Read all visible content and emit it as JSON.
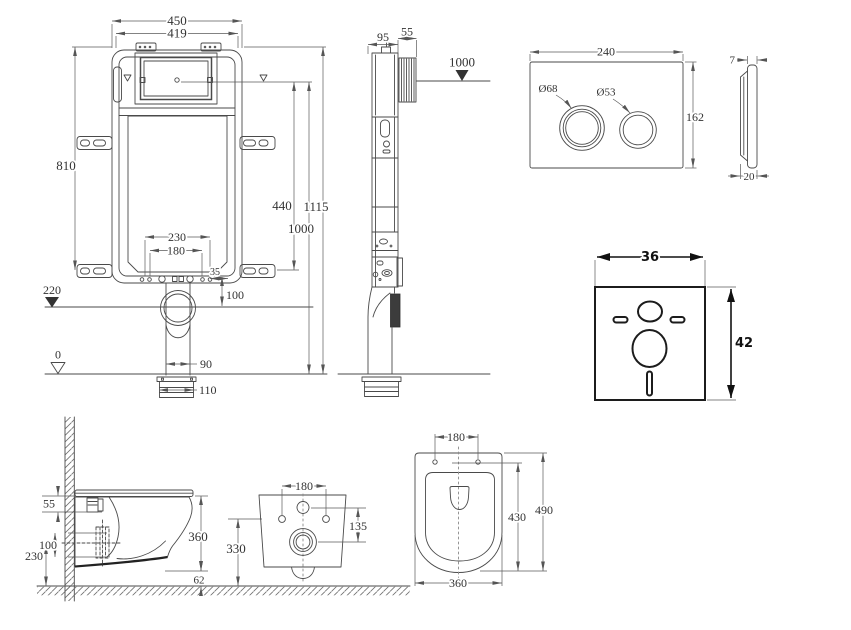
{
  "drawing": {
    "background": "#ffffff",
    "line_color": "#4a4a4a",
    "text_color": "#333333",
    "mat_line_color": "#1c1c1c",
    "views": {
      "cistern_front": {
        "label": "concealed cistern frame front view",
        "dims": {
          "width_outer": "450",
          "width_inner": "419",
          "height": "810",
          "flush_center": "440",
          "total_height": "1115",
          "center_height": "1000",
          "bolt_outer": "230",
          "bolt_inner": "180",
          "edge_offset": "35",
          "outlet_drop": "100",
          "level_upper": "220",
          "level_zero": "0",
          "pipe_width": "90",
          "foot_width": "110"
        }
      },
      "cistern_side": {
        "label": "frame side view",
        "dims": {
          "depth": "95",
          "wall_pipe": "55",
          "level": "1000"
        }
      },
      "flush_plate_front": {
        "label": "flush plate front view",
        "dims": {
          "width": "240",
          "height": "162",
          "big_button": "Ø68",
          "small_button": "Ø53"
        }
      },
      "flush_plate_side": {
        "label": "flush plate side view",
        "dims": {
          "thickness": "7",
          "depth": "20"
        }
      },
      "sound_mat": {
        "label": "sound insulation mat",
        "dims": {
          "width": "36",
          "height": "42"
        }
      },
      "toilet_side": {
        "label": "wall-hung toilet side view",
        "dims": {
          "fixing": "55",
          "outlet_offset": "100",
          "outlet_height": "230",
          "body_height": "360",
          "clearance": "62"
        }
      },
      "toilet_rear": {
        "label": "toilet rear view",
        "dims": {
          "hole_spacing": "180",
          "outlet_offset": "135",
          "height": "330"
        }
      },
      "toilet_top": {
        "label": "toilet top view",
        "dims": {
          "hole_spacing": "180",
          "bowl_length": "430",
          "total_length": "490",
          "width": "360"
        }
      }
    }
  }
}
